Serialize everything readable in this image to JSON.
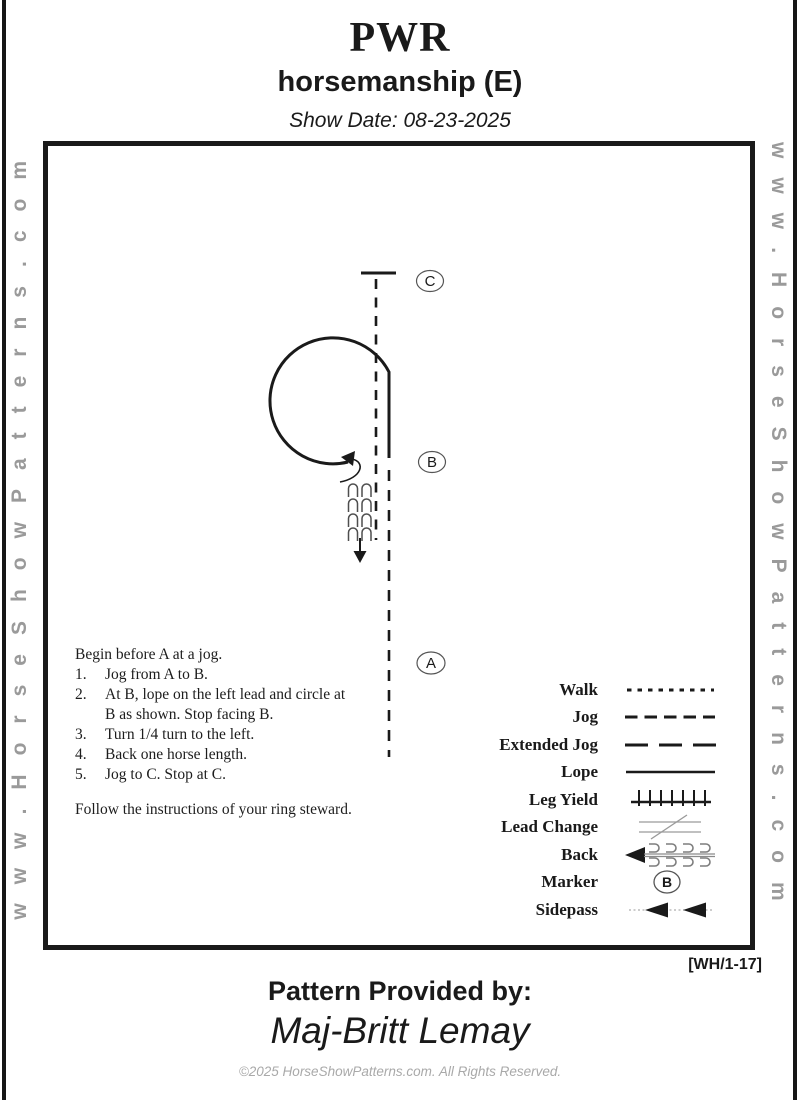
{
  "header": {
    "title": "PWR",
    "subtitle": "horsemanship (E)",
    "show_date": "Show Date: 08-23-2025"
  },
  "watermarks": {
    "left": "www.HorseShowPatterns.com",
    "right": "www.HorseShowPatterns.com"
  },
  "diagram": {
    "marker_c": "C",
    "marker_b": "B",
    "marker_a": "A",
    "intro": "Begin before A at a jog.",
    "steps": [
      {
        "num": "1.",
        "lines": [
          "Jog from A to B."
        ]
      },
      {
        "num": "2.",
        "lines": [
          "At B, lope on the left lead and circle at",
          "B as shown.  Stop facing B."
        ]
      },
      {
        "num": "3.",
        "lines": [
          "Turn 1/4 turn to the left."
        ]
      },
      {
        "num": "4.",
        "lines": [
          "Back one horse length."
        ]
      },
      {
        "num": "5.",
        "lines": [
          "Jog to C.  Stop at C."
        ]
      }
    ],
    "note": "Follow the instructions of  your ring steward."
  },
  "legend": {
    "items": [
      {
        "label": "Walk"
      },
      {
        "label": "Jog"
      },
      {
        "label": "Extended Jog"
      },
      {
        "label": "Lope"
      },
      {
        "label": "Leg Yield"
      },
      {
        "label": "Lead Change"
      },
      {
        "label": "Back"
      },
      {
        "label": "Marker",
        "letter": "B"
      },
      {
        "label": "Sidepass"
      }
    ]
  },
  "footer": {
    "pattern_code": "[WH/1-17]",
    "provided_by_label": "Pattern Provided by:",
    "provided_by_name": "Maj-Britt Lemay",
    "copyright": "©2025 HorseShowPatterns.com. All Rights Reserved."
  },
  "colors": {
    "ink": "#1a1a1a",
    "watermark_gray": "#9a9a9a",
    "muted_gray": "#a9a9a9"
  }
}
